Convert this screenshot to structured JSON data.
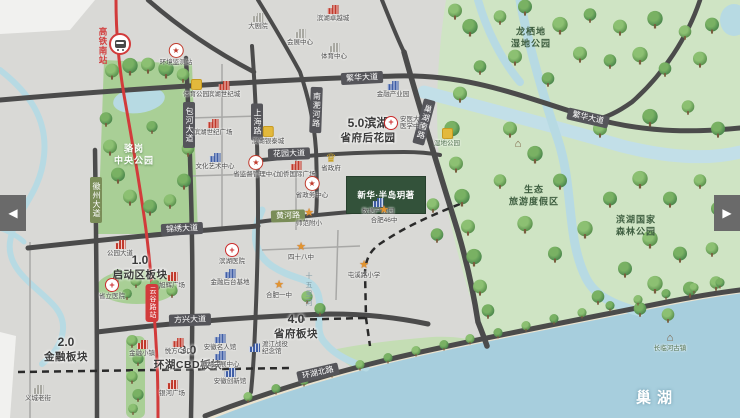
{
  "carousel": {
    "prev_label": "◀",
    "next_label": "▶"
  },
  "transit": {
    "hsr_station": "高铁南站",
    "metro_station": "云谷路站"
  },
  "project": {
    "name": "新华·半岛玥著"
  },
  "colors": {
    "metro_line": "#d23b3b",
    "road_dark": "#4b4b4b",
    "park_green": "#cfe4c4",
    "lake_blue": "#a7cedd",
    "zone_text": "#3a3a3a"
  },
  "zones": [
    {
      "num": "1.0",
      "name": "启动区板块",
      "x": 140,
      "y": 268
    },
    {
      "num": "2.0",
      "name": "金融板块",
      "x": 66,
      "y": 350
    },
    {
      "num": "3.0",
      "name": "环湖CBD板块",
      "x": 188,
      "y": 358
    },
    {
      "num": "4.0",
      "name": "省府板块",
      "x": 296,
      "y": 327
    },
    {
      "num": "5.0滨湖",
      "name": "省府后花园",
      "x": 368,
      "y": 131
    }
  ],
  "road_badges": [
    {
      "name": "繁华大道",
      "x": 362,
      "y": 78,
      "rot": -3,
      "vertical": false,
      "style": "dark"
    },
    {
      "name": "繁华大道",
      "x": 588,
      "y": 118,
      "rot": 13,
      "vertical": false,
      "style": "dark"
    },
    {
      "name": "锦绣大道",
      "x": 182,
      "y": 229,
      "rot": -3,
      "vertical": false,
      "style": "dark"
    },
    {
      "name": "方兴大道",
      "x": 190,
      "y": 320,
      "rot": -2,
      "vertical": false,
      "style": "dark"
    },
    {
      "name": "环湖北路",
      "x": 318,
      "y": 373,
      "rot": -13,
      "vertical": false,
      "style": "dark"
    },
    {
      "name": "花园大道",
      "x": 289,
      "y": 154,
      "rot": -2,
      "vertical": false,
      "style": "dark"
    },
    {
      "name": "黄河路",
      "x": 288,
      "y": 216,
      "rot": -2,
      "vertical": false,
      "style": "green"
    },
    {
      "name": "徽州大道",
      "x": 96,
      "y": 200,
      "rot": 0,
      "vertical": true,
      "style": "green"
    },
    {
      "name": "包河大道",
      "x": 189,
      "y": 125,
      "rot": 0,
      "vertical": true,
      "style": "dark"
    },
    {
      "name": "上海路",
      "x": 257,
      "y": 122,
      "rot": 0,
      "vertical": true,
      "style": "dark"
    },
    {
      "name": "南淝河路",
      "x": 316,
      "y": 110,
      "rot": 2,
      "vertical": true,
      "style": "dark"
    },
    {
      "name": "巢湖南路",
      "x": 424,
      "y": 122,
      "rot": 15,
      "vertical": true,
      "style": "dark"
    }
  ],
  "park_labels": [
    {
      "text": "骆岗\n中央公园",
      "x": 134,
      "y": 155,
      "cls": "white"
    },
    {
      "text": "龙栖地\n湿地公园",
      "x": 531,
      "y": 38,
      "cls": ""
    },
    {
      "text": "生态\n旅游度假区",
      "x": 534,
      "y": 196,
      "cls": ""
    },
    {
      "text": "滨湖国家\n森林公园",
      "x": 636,
      "y": 226,
      "cls": ""
    }
  ],
  "water_labels": [
    {
      "text": "巢湖",
      "x": 657,
      "y": 397,
      "cls": "lake"
    },
    {
      "text": "十五里河",
      "x": 308,
      "y": 290,
      "cls": "v"
    }
  ],
  "pois": [
    {
      "type": "grayb",
      "label": "大剧院",
      "x": 258,
      "y": 18
    },
    {
      "type": "grayb",
      "label": "会展中心",
      "x": 300,
      "y": 34
    },
    {
      "type": "grayb",
      "label": "体育中心",
      "x": 334,
      "y": 48
    },
    {
      "type": "red",
      "label": "滨湖卓越城",
      "x": 333,
      "y": 10
    },
    {
      "type": "star",
      "label": "环境监测站",
      "x": 176,
      "y": 48
    },
    {
      "type": "red",
      "label": "滨湖世纪城",
      "x": 224,
      "y": 86
    },
    {
      "type": "gold",
      "label": "体育公园",
      "x": 196,
      "y": 84
    },
    {
      "type": "blue",
      "label": "金融产业园",
      "x": 393,
      "y": 86
    },
    {
      "type": "red",
      "label": "滨湖世纪广场",
      "x": 213,
      "y": 124
    },
    {
      "type": "gold",
      "label": "滨湖银泰城",
      "x": 268,
      "y": 131
    },
    {
      "type": "cross",
      "label": "安医大\n医学中心",
      "x": 389,
      "y": 123,
      "lp": "r"
    },
    {
      "type": "blue",
      "label": "文化艺术中心",
      "x": 215,
      "y": 158
    },
    {
      "type": "star",
      "label": "省监督管理中心",
      "x": 256,
      "y": 160
    },
    {
      "type": "red",
      "label": "加侨国际广场",
      "x": 296,
      "y": 166
    },
    {
      "type": "crown",
      "label": "省政府",
      "x": 331,
      "y": 157
    },
    {
      "type": "star",
      "label": "省政务中心",
      "x": 312,
      "y": 181
    },
    {
      "type": "blue",
      "label": "数据产业园",
      "x": 378,
      "y": 203
    },
    {
      "type": "school",
      "label": "师范附小",
      "x": 309,
      "y": 213
    },
    {
      "type": "school",
      "label": "合肥46中",
      "x": 384,
      "y": 210
    },
    {
      "type": "park",
      "label": "湿地公园",
      "x": 447,
      "y": 133
    },
    {
      "type": "red",
      "label": "公园大道",
      "x": 120,
      "y": 245
    },
    {
      "type": "school",
      "label": "四十八中",
      "x": 301,
      "y": 247
    },
    {
      "type": "cross",
      "label": "滨湖医院",
      "x": 232,
      "y": 248
    },
    {
      "type": "school",
      "label": "屯溪路小学",
      "x": 364,
      "y": 265
    },
    {
      "type": "blue",
      "label": "金融后台基地",
      "x": 230,
      "y": 274
    },
    {
      "type": "red",
      "label": "旭辉广场",
      "x": 172,
      "y": 277
    },
    {
      "type": "school",
      "label": "合肥一中",
      "x": 279,
      "y": 285
    },
    {
      "type": "cross",
      "label": "省立医院",
      "x": 112,
      "y": 283
    },
    {
      "type": "red",
      "label": "金融小镇",
      "x": 142,
      "y": 345
    },
    {
      "type": "red",
      "label": "悦方CBD",
      "x": 178,
      "y": 343
    },
    {
      "type": "blue",
      "label": "安徽名人馆",
      "x": 220,
      "y": 339
    },
    {
      "type": "blue",
      "label": "渡江战役\n纪念馆",
      "x": 254,
      "y": 348,
      "lp": "r"
    },
    {
      "type": "blue",
      "label": "滨湖会展中心",
      "x": 220,
      "y": 356
    },
    {
      "type": "blue",
      "label": "安徽创新馆",
      "x": 230,
      "y": 373
    },
    {
      "type": "red",
      "label": "银河广场",
      "x": 172,
      "y": 385
    },
    {
      "type": "grayb",
      "label": "义城老街",
      "x": 38,
      "y": 390
    },
    {
      "type": "house",
      "label": "长临河古镇",
      "x": 670,
      "y": 338
    },
    {
      "type": "house",
      "label": "",
      "x": 518,
      "y": 144
    }
  ]
}
